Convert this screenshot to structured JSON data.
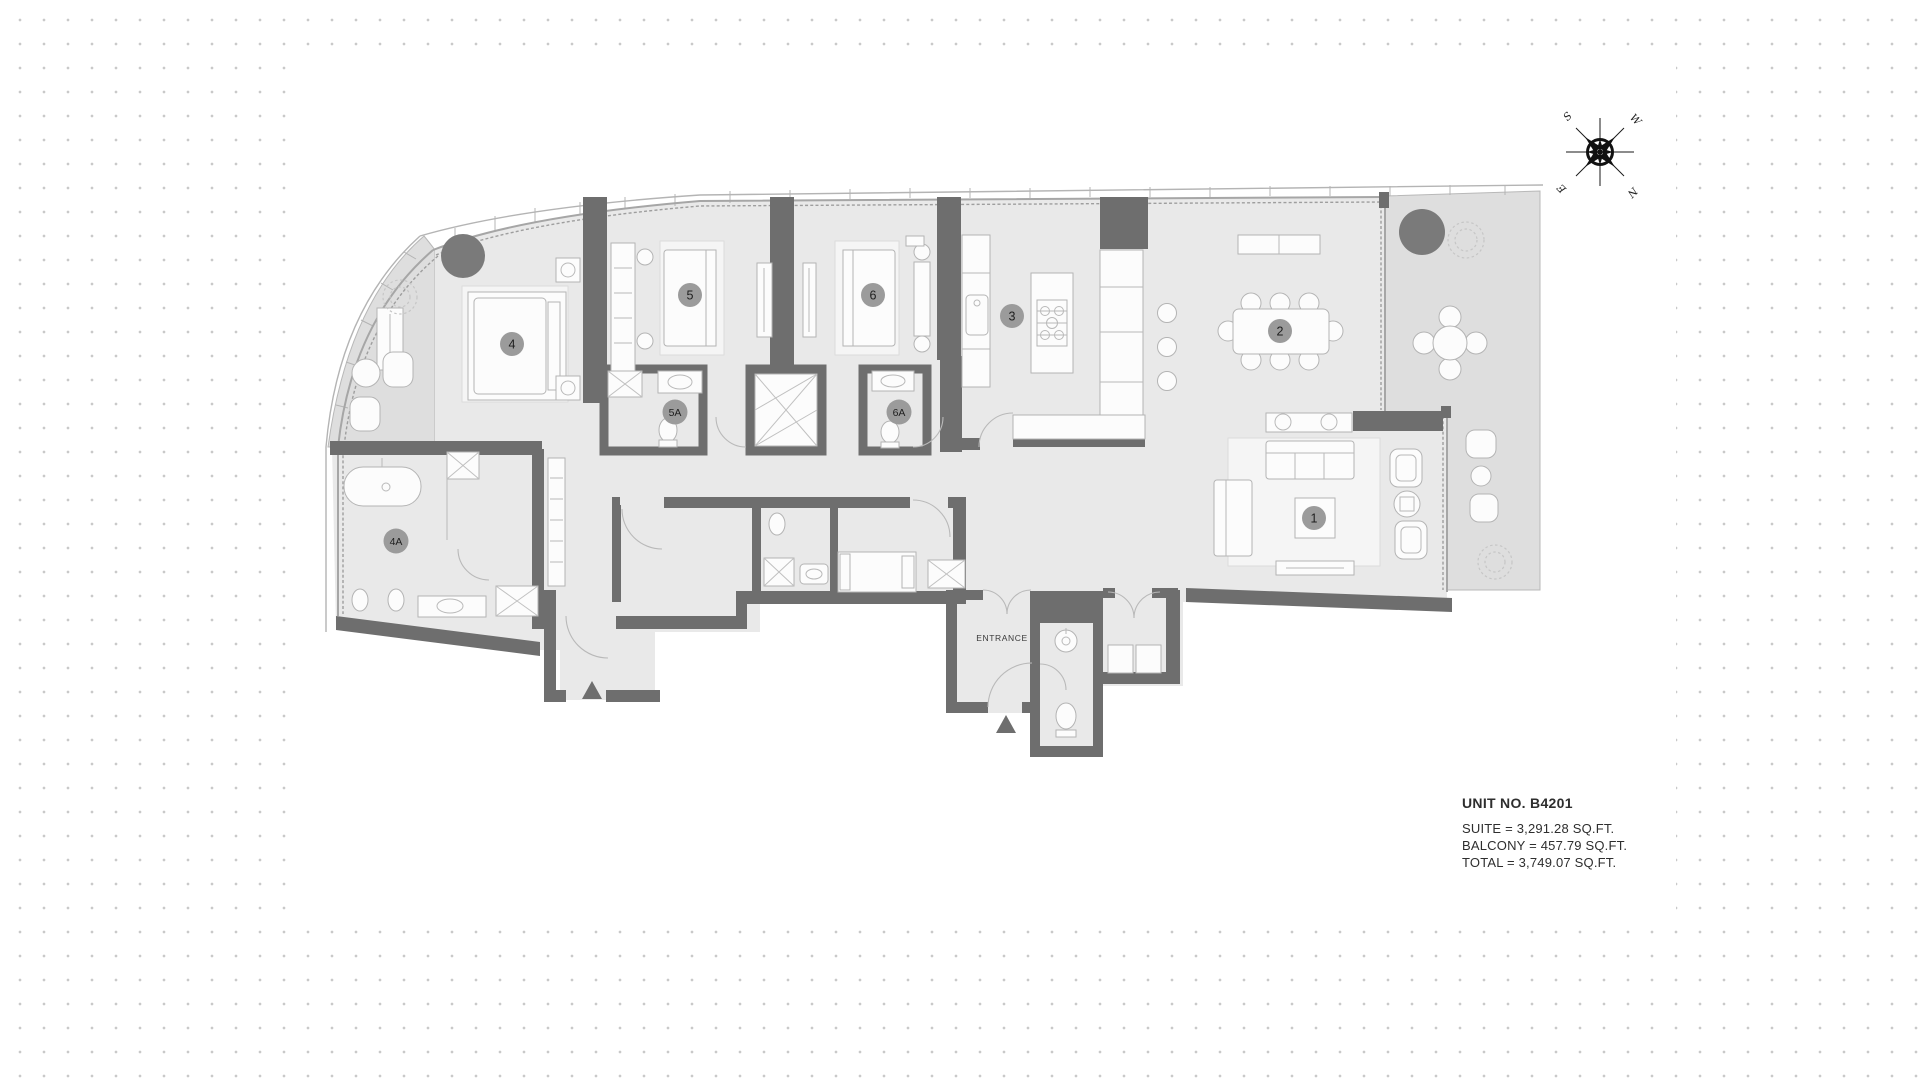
{
  "unit_info": {
    "title": "UNIT NO. B4201",
    "lines": [
      "SUITE = 3,291.28 SQ.FT.",
      "BALCONY = 457.79 SQ.FT.",
      "TOTAL = 3,749.07 SQ.FT."
    ]
  },
  "entrance": {
    "label": "ENTRANCE"
  },
  "compass": {
    "north": "N",
    "south": "S",
    "east": "E",
    "west": "W"
  },
  "rooms": [
    {
      "id": "living-room",
      "label": "1"
    },
    {
      "id": "dining-room",
      "label": "2"
    },
    {
      "id": "kitchen",
      "label": "3"
    },
    {
      "id": "bedroom-4",
      "label": "4"
    },
    {
      "id": "bathroom-4a",
      "label": "4A"
    },
    {
      "id": "bedroom-5",
      "label": "5"
    },
    {
      "id": "bathroom-5a",
      "label": "5A"
    },
    {
      "id": "bedroom-6",
      "label": "6"
    },
    {
      "id": "bathroom-6a",
      "label": "6A"
    }
  ],
  "colors": {
    "wall": "#6e6e6e",
    "floor": "#e9e9e9",
    "balcony_floor": "#dedede",
    "label_badge": "#9b9b9b",
    "planter": "#7a7a7a",
    "background_dot": "#c9c9c9",
    "text": "#2e2e2e"
  }
}
